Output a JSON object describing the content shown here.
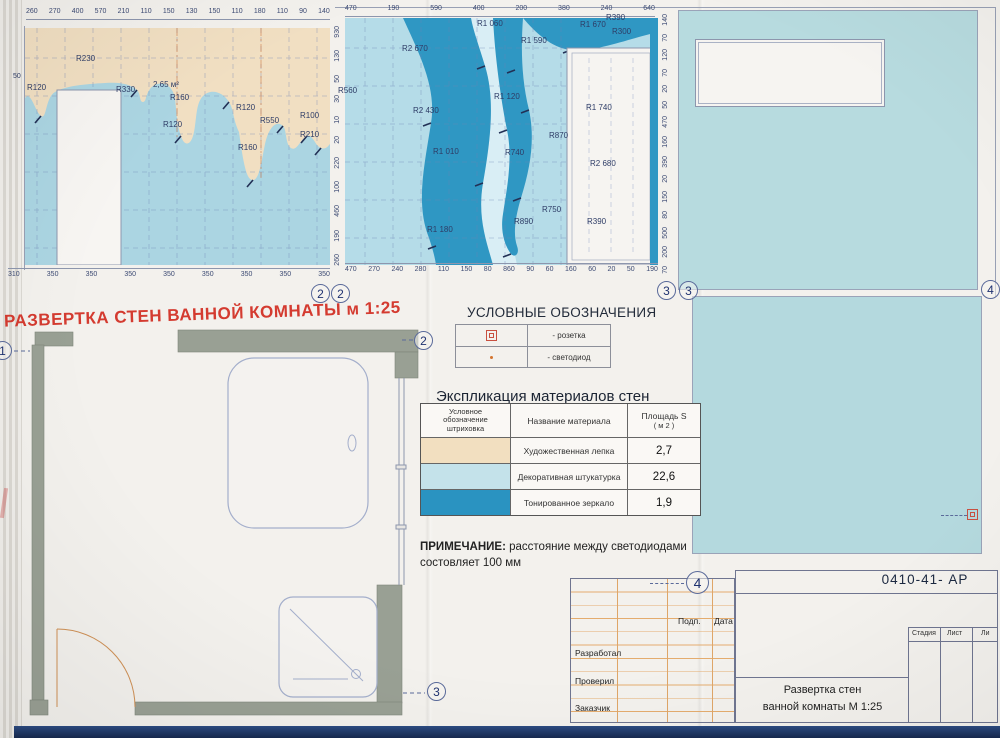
{
  "page": {
    "sheet_title": "РАЗВЕРТКА СТЕН ВАННОЙ КОМНАТЫ  м 1:25",
    "title_color": "#d43b30"
  },
  "colors": {
    "molding_beige": "#f1dfc2",
    "plaster_blue": "#b5dce8",
    "mirror_teal": "#2f97c3",
    "wall_gray": "#99a094",
    "bottom_strip": "#1e3a6e"
  },
  "elev1": {
    "top_dims": [
      "260",
      "270",
      "400",
      "570",
      "210",
      "110",
      "150",
      "130",
      "150",
      "110",
      "180",
      "110",
      "90",
      "140"
    ],
    "bottom_dims": [
      "310",
      "350",
      "350",
      "350",
      "350",
      "350",
      "350",
      "350",
      "350"
    ],
    "side_dims": [
      "930",
      "130",
      "50",
      "30",
      "10",
      "20",
      "220",
      "100",
      "460",
      "190",
      "260"
    ],
    "labels": {
      "n50": "50",
      "r120a": "R120",
      "r230": "R230",
      "r330": "R330",
      "area": "2,65 м²",
      "r160a": "R160",
      "r120b": "R120",
      "r120c": "R120",
      "r550": "R550",
      "r100": "R100",
      "r210": "R210",
      "r160b": "R160"
    }
  },
  "elev2": {
    "top_dims": [
      "470",
      "190",
      "590",
      "400",
      "200",
      "380",
      "240",
      "640"
    ],
    "bottom_dims": [
      "470",
      "270",
      "240",
      "280",
      "110",
      "150",
      "80",
      "860",
      "90",
      "60",
      "160",
      "60",
      "20",
      "50",
      "190"
    ],
    "side_dims": [
      "140",
      "70",
      "120",
      "70",
      "20",
      "50",
      "470",
      "160",
      "390",
      "20",
      "150",
      "80",
      "500",
      "200",
      "70"
    ],
    "labels": {
      "r560": "R560",
      "r2670": "R2 670",
      "r1060": "R1 060",
      "r1590": "R1 590",
      "r1670": "R1 670",
      "r390a": "R390",
      "r300": "R300",
      "r2430": "R2 430",
      "r1120": "R1 120",
      "r1740": "R1 740",
      "r870": "R870",
      "r1010": "R1 010",
      "r740": "R740",
      "r2680": "R2 680",
      "r750": "R750",
      "r890": "R890",
      "r390b": "R390",
      "r1180": "R1 180"
    }
  },
  "markers": {
    "m2a": "2",
    "m2b": "2",
    "m3a": "3",
    "m3b": "3",
    "m4edge": "4",
    "plan_top": "2",
    "plan_left": "1",
    "plan_bottom": "3",
    "titleblock": "4"
  },
  "legend": {
    "heading": "УСЛОВНЫЕ ОБОЗНАЧЕНИЯ",
    "rows": [
      {
        "symbol": "socket-icon",
        "label": "- розетка"
      },
      {
        "symbol": "led-icon",
        "label": "- светодиод"
      }
    ]
  },
  "materials": {
    "title": "Экспликация материалов стен",
    "header": {
      "col1a": "Условное",
      "col1b": "обозначение",
      "col1c": "штриховка",
      "col2": "Название материала",
      "col3a": "Площадь S",
      "col3b": "( м 2 )"
    },
    "rows": [
      {
        "name": "Художественная лепка",
        "area": "2,7",
        "swatch": "#f2dfc0"
      },
      {
        "name": "Декоративная штукатурка",
        "area": "22,6",
        "swatch": "#c4e2ea"
      },
      {
        "name": "Тонированное зеркало",
        "area": "1,9",
        "swatch": "#2a93c1"
      }
    ]
  },
  "note": {
    "label": "ПРИМЕЧАНИЕ:",
    "text1": "расстояние между светодиодами",
    "text2": "состовляет 100 мм"
  },
  "title_block": {
    "code": "0410-41-  АР",
    "sign_col": "Подп.",
    "date_col": "Дата",
    "row1": "Разработал",
    "row2": "Проверил",
    "row3": "Заказчик",
    "doc1": "Развертка стен",
    "doc2": "ванной комнаты М 1:25",
    "stage": "Стадия",
    "sheet": "Лист",
    "sheets": "Ли"
  }
}
